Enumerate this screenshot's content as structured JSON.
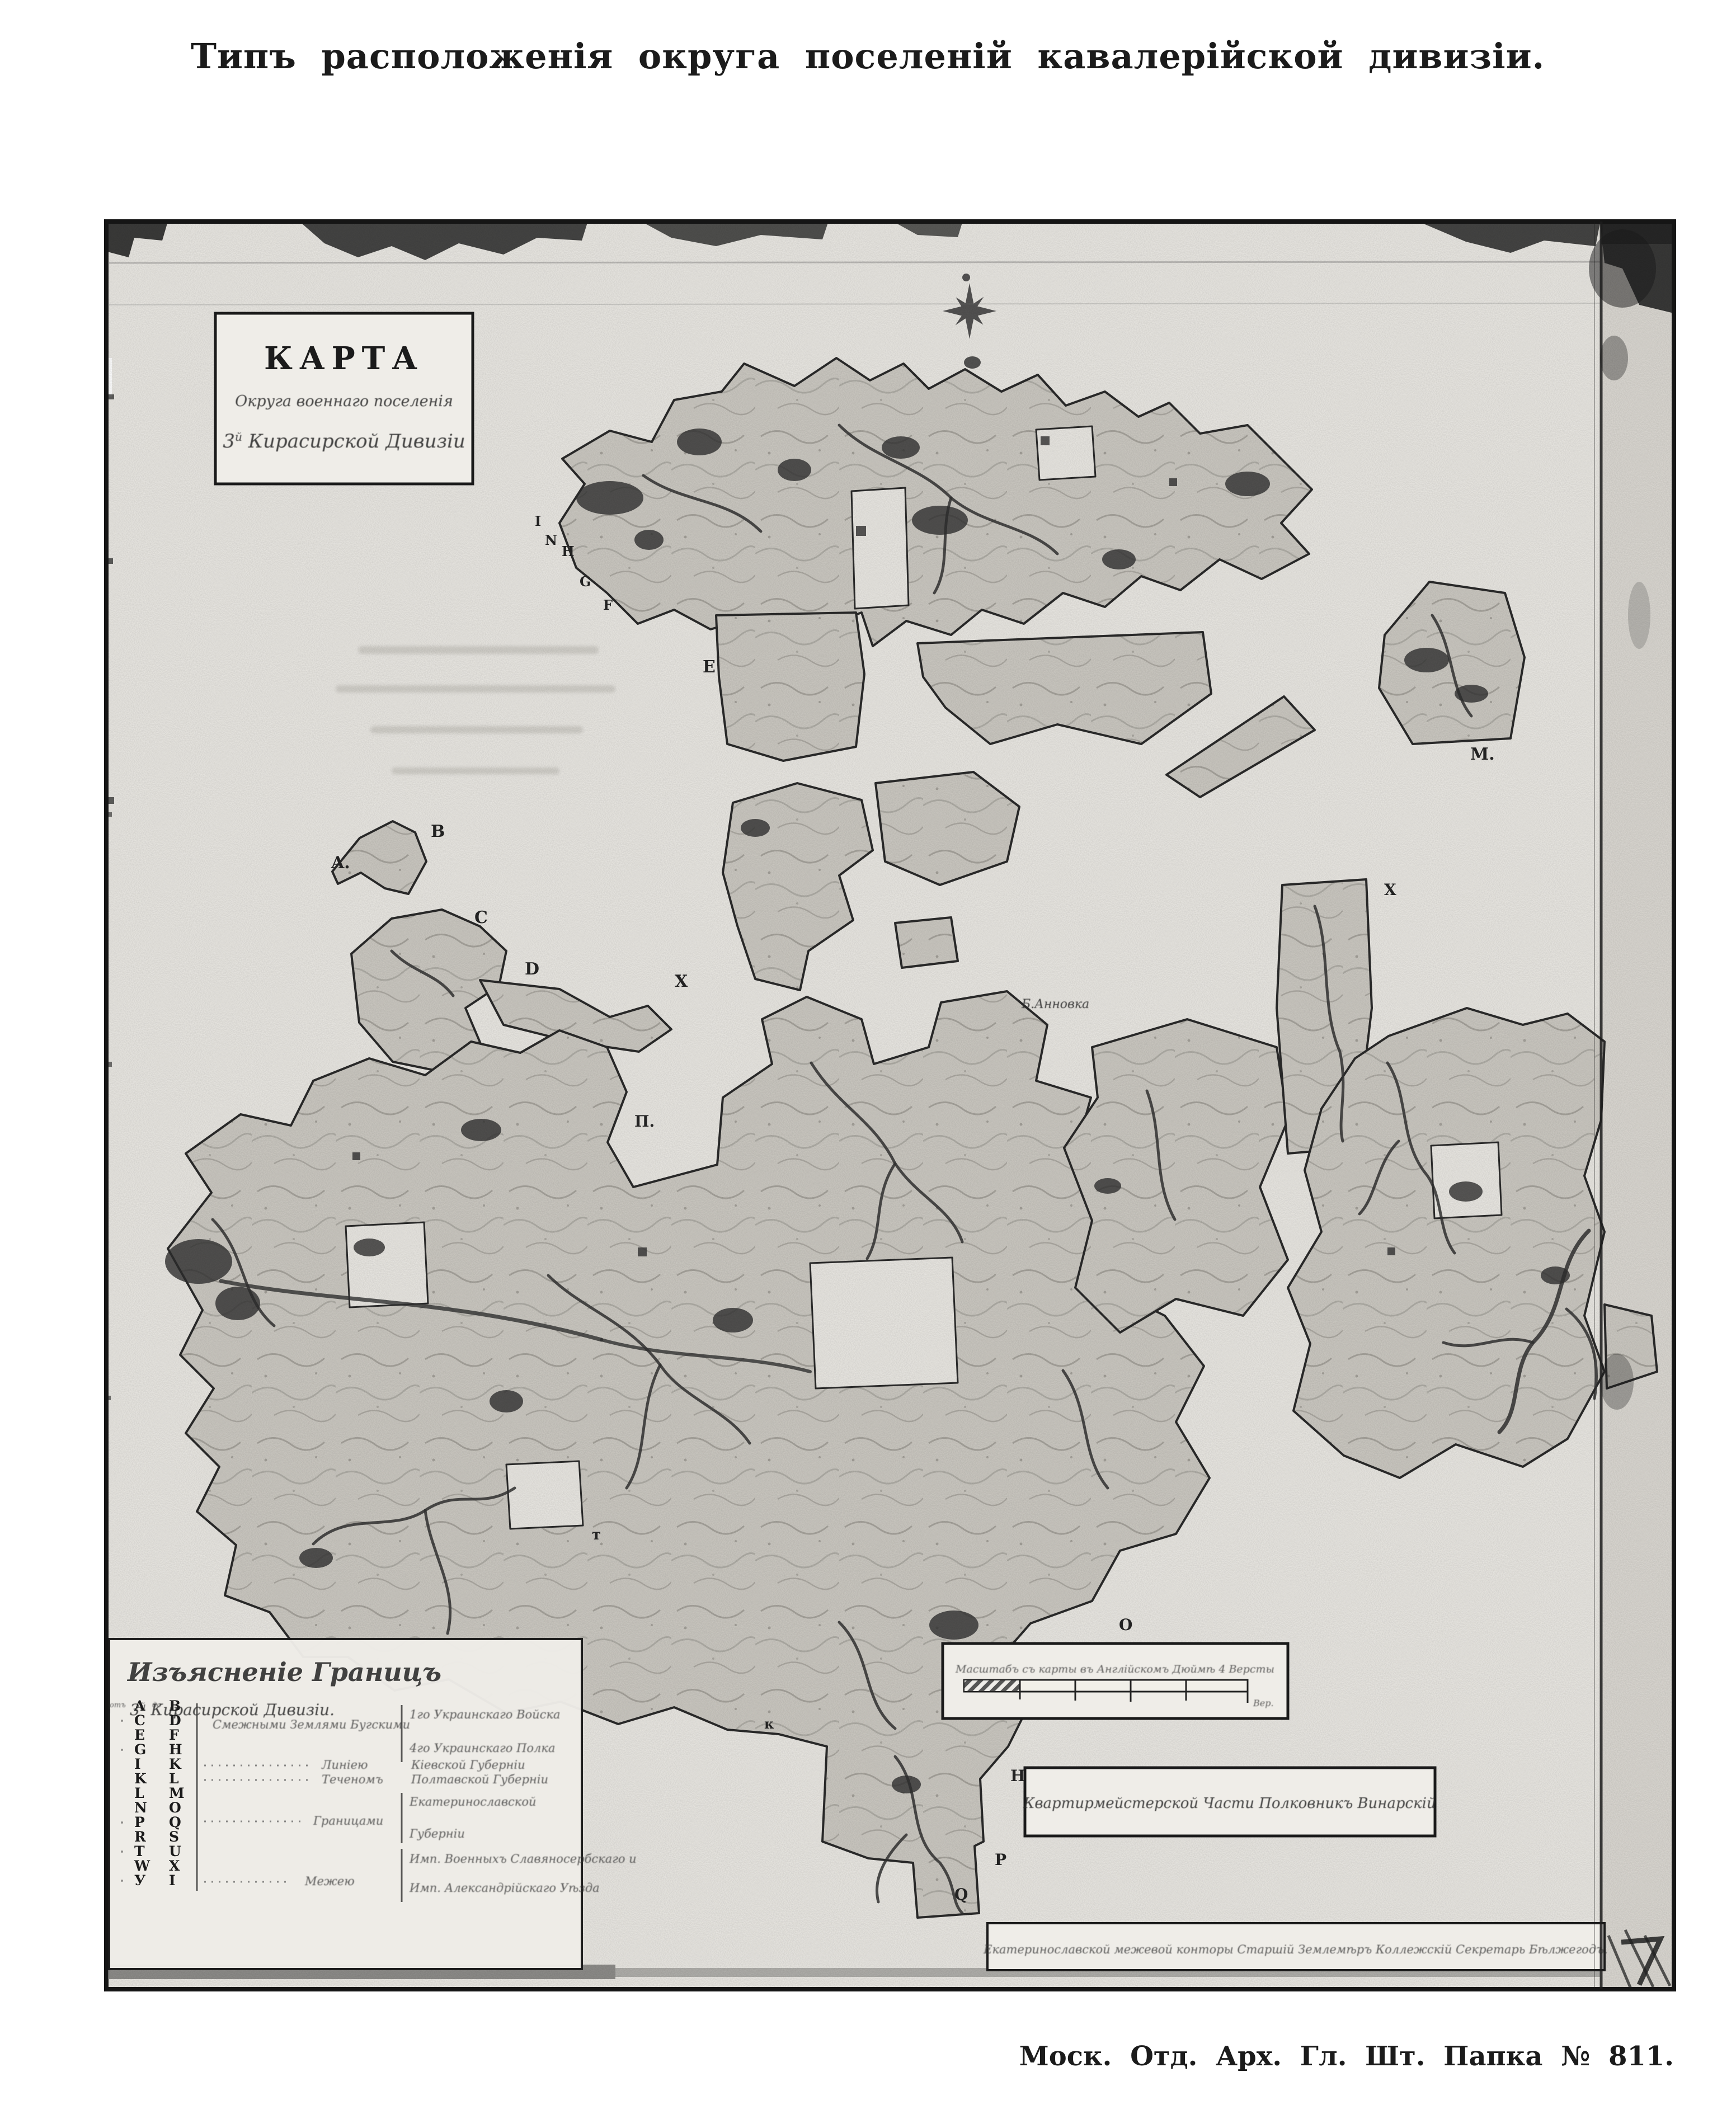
{
  "page": {
    "title": "Типъ расположенія округа поселеній кавалерійской дивизіи.",
    "archive_caption": "Моск. Отд. Арх. Гл. Шт. Папка № 811."
  },
  "map": {
    "karta_box": {
      "line1": "КАРТА",
      "line2": "Округа военнаго поселенія",
      "line3_num": "3",
      "line3_sup": "й",
      "line3_rest": " Кирасирской Дивизіи"
    },
    "legend": {
      "title": "Изъясненіе Границъ",
      "subtitle_num": "3",
      "subtitle_sup": "й",
      "subtitle_rest": " Кирасирской Дивизіи.",
      "rows": [
        [
          "A",
          "B"
        ],
        [
          "C",
          "D"
        ],
        [
          "E",
          "F"
        ],
        [
          "G",
          "H"
        ],
        [
          "I",
          "K"
        ],
        [
          "K",
          "L"
        ],
        [
          "L",
          "M"
        ],
        [
          "N",
          "O"
        ],
        [
          "P",
          "Q"
        ],
        [
          "R",
          "S"
        ],
        [
          "T",
          "U"
        ],
        [
          "W",
          "X"
        ],
        [
          "У",
          "I"
        ]
      ],
      "entries": {
        "row0_from": "отъ",
        "row0_to": "до",
        "adjacent_label": "Смежными Землями Бугскими",
        "brace_top": "1го Украинскаго Войска",
        "brace_bottom": "4го Украинскаго Полка",
        "kiev_lead": "Линіею",
        "kiev": "Кіевской Губерніи",
        "poltava_lead": "Теченомъ",
        "poltava": "Полтавской Губерніи",
        "ekat_lead": "Границами",
        "ekat_top": "Екатеринославской",
        "ekat_bottom": "Губерніи",
        "slavyanoserb": "Имп. Военныхъ Славяносербскаго и",
        "mezh_lead": "Межею",
        "alexandria": "Имп. Александрійскаго Уѣзда"
      }
    },
    "scale_box": {
      "caption": "Масштабъ съ карты въ Англійскомъ Дюймѣ 4 Версты",
      "unit": "Вер."
    },
    "surveyor_box": "Квартирмейстерской Части Полковникъ Винарскій",
    "secretary_box": "Екатеринославской межевой конторы Старшій Землемѣръ Коллежскій Секретарь Бѣлжегодъ.",
    "labels": [
      {
        "t": "A."
      },
      {
        "t": "B"
      },
      {
        "t": "C"
      },
      {
        "t": "D"
      },
      {
        "t": "X"
      },
      {
        "t": "E"
      },
      {
        "t": "I"
      },
      {
        "t": "N"
      },
      {
        "t": "H"
      },
      {
        "t": "G"
      },
      {
        "t": "F"
      },
      {
        "t": "M."
      },
      {
        "t": "X"
      },
      {
        "t": "П."
      },
      {
        "t": "т"
      },
      {
        "t": "О"
      },
      {
        "t": "Н."
      },
      {
        "t": "P"
      },
      {
        "t": "Q"
      },
      {
        "t": "к"
      },
      {
        "t": "Б.Анновка"
      }
    ]
  }
}
